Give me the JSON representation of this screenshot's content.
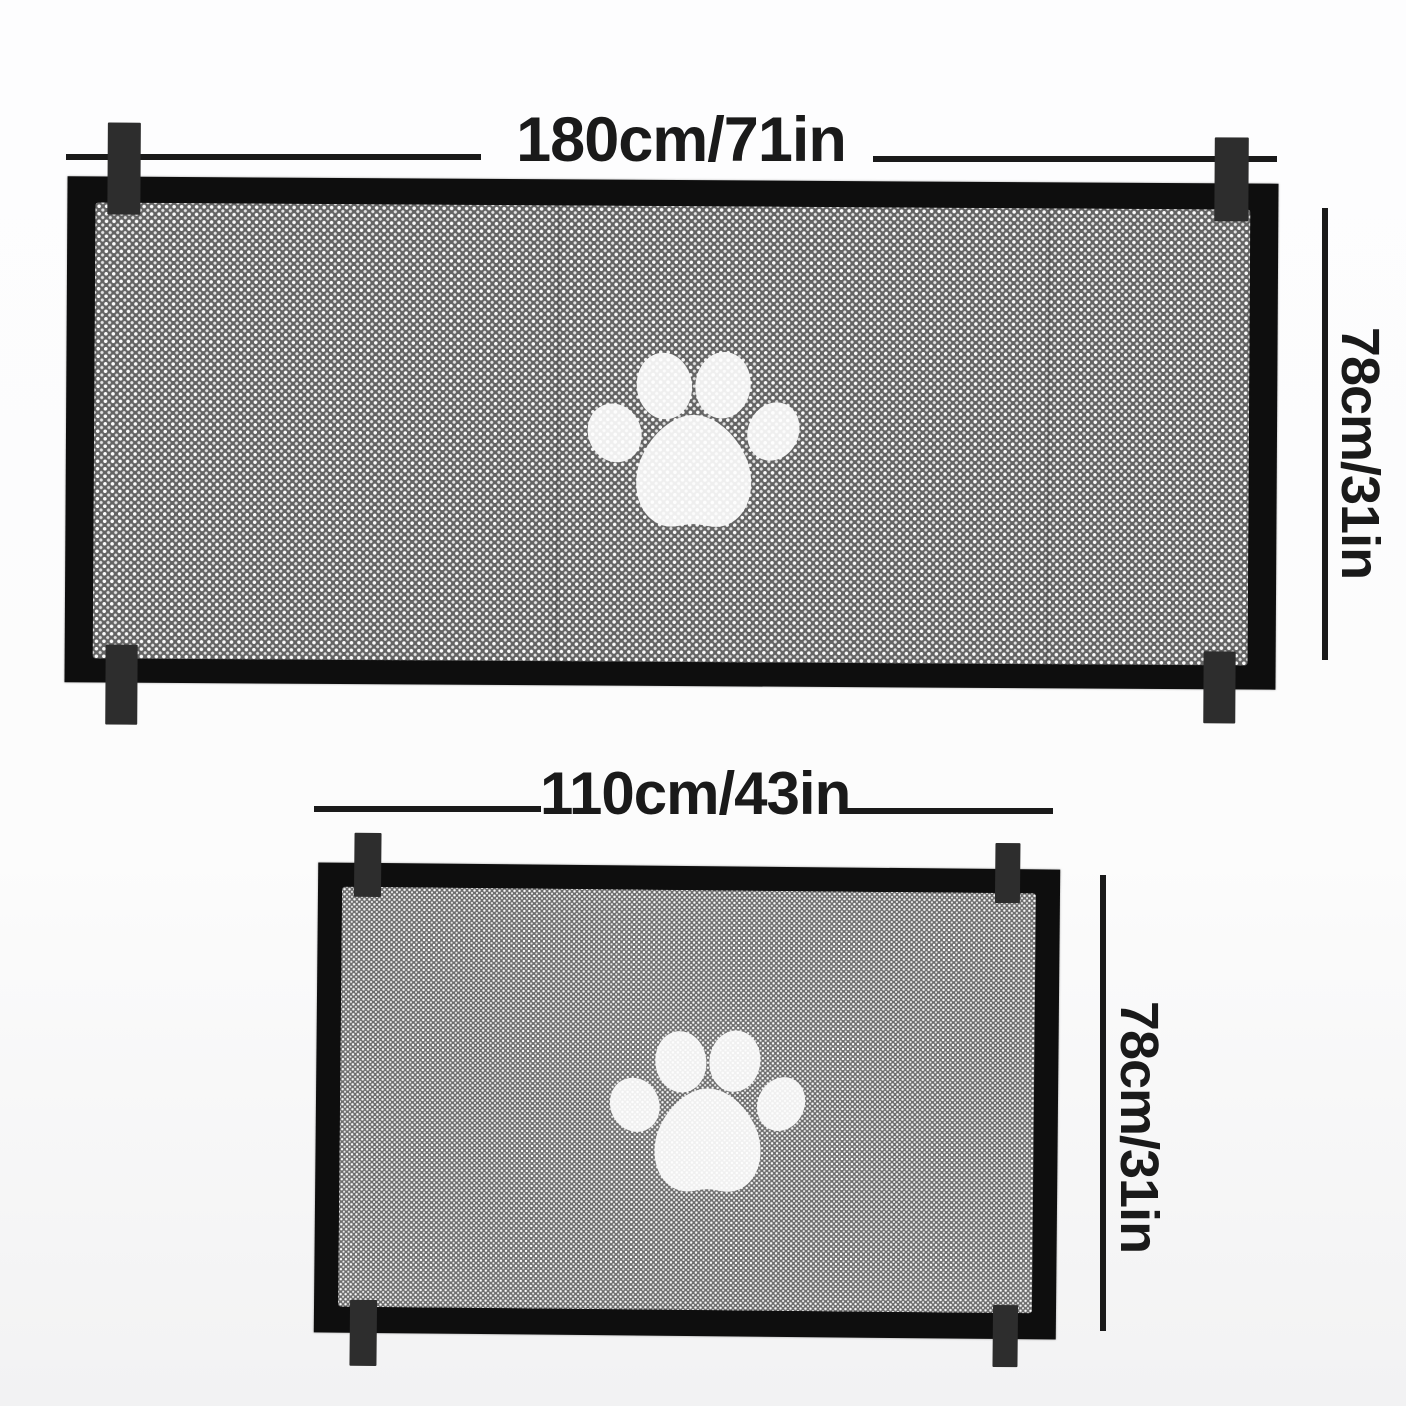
{
  "product_diagram": {
    "large_gate": {
      "width_label": "180cm/71in",
      "height_label": "78cm/31in",
      "tab_count": 4,
      "paw_icon": "paw-print-icon"
    },
    "small_gate": {
      "width_label": "110cm/43in",
      "height_label": "78cm/31in",
      "tab_count": 4,
      "paw_icon": "paw-print-icon"
    },
    "colors": {
      "frame": "#0e0e0e",
      "tab": "#2d2d2d",
      "dimension": "#1a1a1a",
      "mesh_base": "#646464",
      "mesh_dot": "#fbfbfb",
      "paw": "#ffffff",
      "background": "#fdfdfe"
    }
  }
}
